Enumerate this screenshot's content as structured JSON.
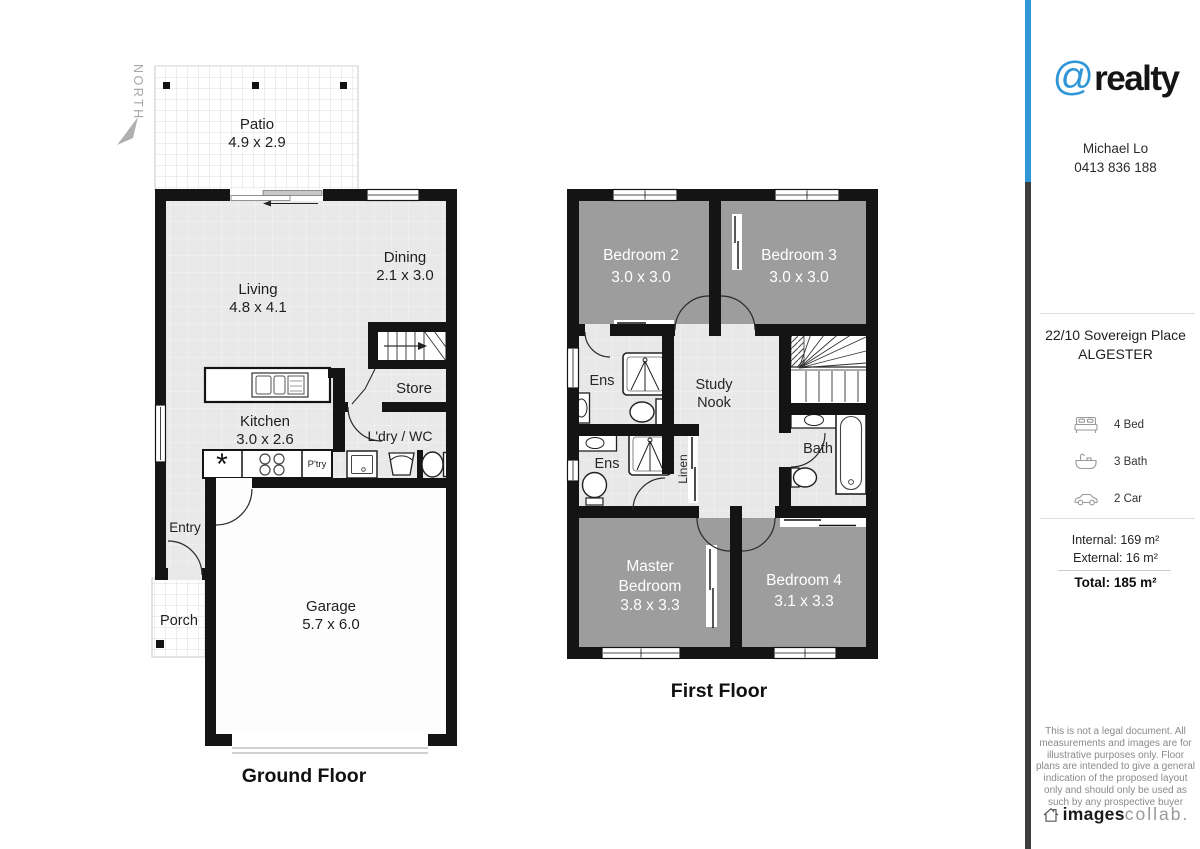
{
  "plan": {
    "north_label": "NORTH",
    "ground": {
      "title": "Ground Floor",
      "patio_name": "Patio",
      "patio_dims": "4.9 x 2.9",
      "living_name": "Living",
      "living_dims": "4.8 x 4.1",
      "dining_name": "Dining",
      "dining_dims": "2.1 x 3.0",
      "store_name": "Store",
      "kitchen_name": "Kitchen",
      "kitchen_dims": "3.0 x 2.6",
      "pantry_name": "P'try",
      "fridge_symbol": "*",
      "laundry_name": "L'dry / WC",
      "entry_name": "Entry",
      "porch_name": "Porch",
      "garage_name": "Garage",
      "garage_dims": "5.7 x 6.0"
    },
    "first": {
      "title": "First Floor",
      "bedroom2_name": "Bedroom 2",
      "bedroom2_dims": "3.0 x 3.0",
      "bedroom3_name": "Bedroom 3",
      "bedroom3_dims": "3.0 x 3.0",
      "ens_upper_name": "Ens",
      "ens_lower_name": "Ens",
      "study_line1": "Study",
      "study_line2": "Nook",
      "linen_name": "Linen",
      "bath_name": "Bath",
      "master_line1": "Master",
      "master_line2": "Bedroom",
      "master_dims": "3.8 x 3.3",
      "bedroom4_name": "Bedroom 4",
      "bedroom4_dims": "3.1 x 3.3"
    }
  },
  "sidebar": {
    "brand_at": "@",
    "brand_name": "realty",
    "agent_name": "Michael Lo",
    "agent_phone": "0413 836 188",
    "address_line1": "22/10 Sovereign Place",
    "address_line2": "ALGESTER",
    "feature_bed": "4 Bed",
    "feature_bath": "3 Bath",
    "feature_car": "2 Car",
    "area_internal": "Internal: 169 m²",
    "area_external": "External: 16 m²",
    "area_total": "Total: 185 m²",
    "disclaimer": "This is not a legal document. All measurements and images are for illustrative purposes only. Floor plans are intended to give a general indication of the proposed layout only and should only be used as such by any prospective buyer",
    "logo_bold": "images",
    "logo_light": "collab.",
    "colors": {
      "accent_blue": "#2f96d8",
      "bar_dark": "#3d3d3d"
    }
  }
}
